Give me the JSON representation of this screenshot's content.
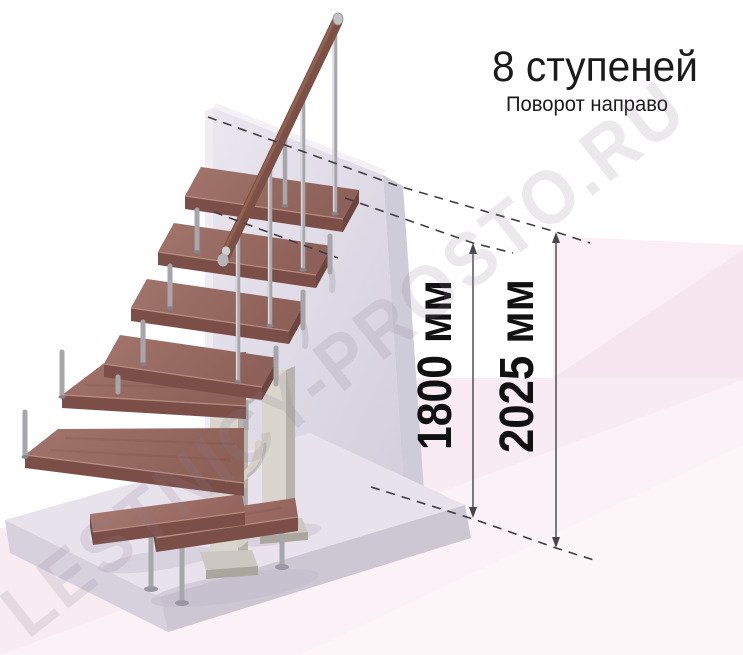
{
  "header": {
    "title": "8 ступеней",
    "subtitle": "Поворот направо"
  },
  "dimensions": {
    "to_top_step": {
      "value": "1800",
      "unit": "мм",
      "label": "1800 мм"
    },
    "to_upper_floor": {
      "value": "2025",
      "unit": "мм",
      "label": "2025 мм"
    }
  },
  "watermark": {
    "text": "LESTNICY-PROSTO.RU"
  },
  "illustration": {
    "type": "3d-render-modular-staircase",
    "steps_shown": 8,
    "colors": {
      "wood_top": "#9a6b64",
      "wood_edge": "#7b4e47",
      "steel": "#a6a6ab",
      "support_beige": "#dad5cd",
      "wall_panel": "#dcd8e4",
      "floor_pink": "#f8ecf2",
      "dimension_line": "#45454a"
    }
  }
}
